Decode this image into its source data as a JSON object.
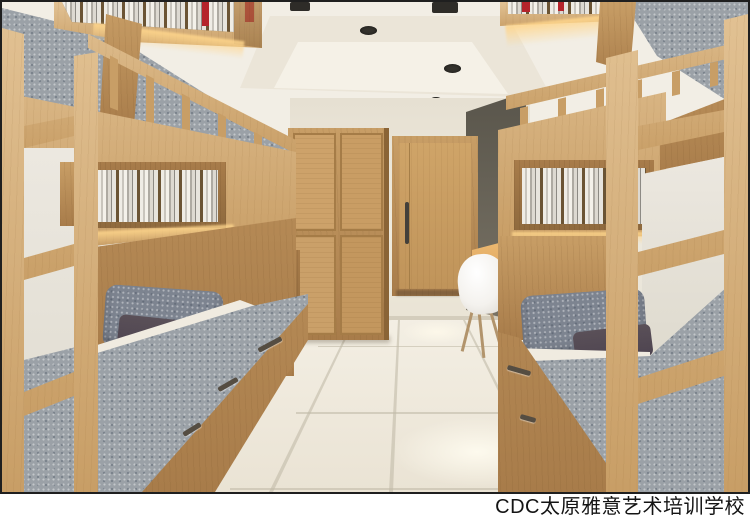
{
  "caption": {
    "text": "CDC太原雅意艺术培训学校"
  },
  "colors": {
    "wood_light": "#e2c294",
    "wood_mid": "#c89e66",
    "wood_dark": "#a87c4a",
    "wood_deep": "#8f6a3e",
    "mattress_gray": "#9ba1a7",
    "pillow_gray": "#7d8490",
    "pillow_plum": "#4e4450",
    "wall_cream": "#ebe6da",
    "ceiling_cream": "#f2eee5",
    "accent_gray": "#6b665a",
    "floor_light": "#f6f2e8",
    "floor_mid": "#eae3d4",
    "glow": "#ffd68c",
    "chair_white": "#f4f2ee",
    "book_red": "#b5242b",
    "frame_dark": "#1f1f1f",
    "caption_text": "#141414"
  },
  "scene": {
    "description": "3D render of a dormitory room with wooden bunk beds on both sides",
    "objects": [
      "left bunk bed",
      "right bunk bed",
      "bookshelves with books",
      "wardrobe",
      "door",
      "gray accent wall",
      "desk",
      "white chairs",
      "tiled floor",
      "ceiling downlights",
      "gray bedding",
      "plum pillows",
      "ladders",
      "under-bed drawers"
    ]
  }
}
